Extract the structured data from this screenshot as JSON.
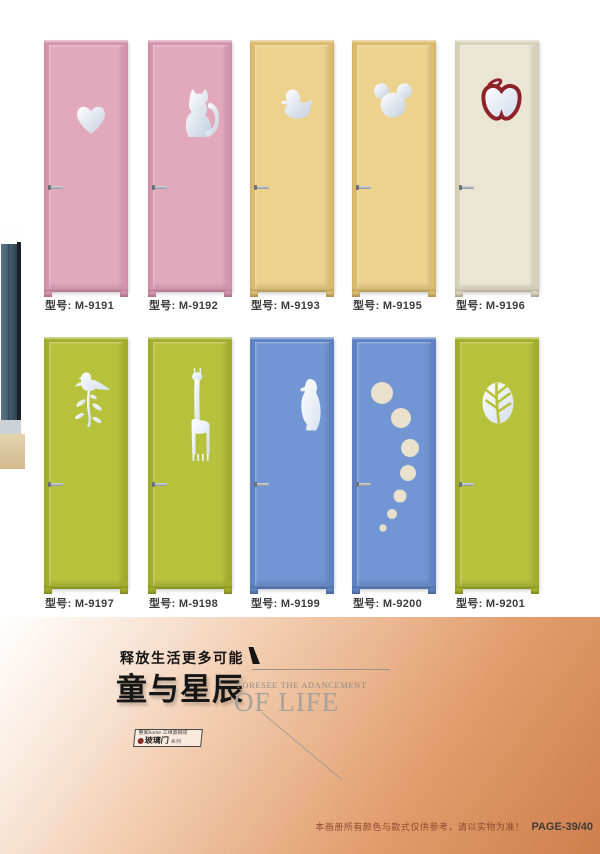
{
  "catalog": {
    "label_field_name": "型号",
    "doors": [
      {
        "model_label": "型号: M-9191",
        "shape": "heart",
        "slab_color": "#e2a9bd"
      },
      {
        "model_label": "型号: M-9192",
        "shape": "cat",
        "slab_color": "#e2a9bd"
      },
      {
        "model_label": "型号: M-9193",
        "shape": "duck",
        "slab_color": "#ecd28c"
      },
      {
        "model_label": "型号: M-9195",
        "shape": "mickey",
        "slab_color": "#ecd28c"
      },
      {
        "model_label": "型号: M-9196",
        "shape": "apple",
        "slab_color": "#ebe5d4"
      },
      {
        "model_label": "型号: M-9197",
        "shape": "bird-flower",
        "slab_color": "#b6c23c"
      },
      {
        "model_label": "型号: M-9198",
        "shape": "giraffe",
        "slab_color": "#b6c23c"
      },
      {
        "model_label": "型号: M-9199",
        "shape": "penguin",
        "slab_color": "#7295d3"
      },
      {
        "model_label": "型号: M-9200",
        "shape": "bubbles",
        "slab_color": "#7295d3"
      },
      {
        "model_label": "型号: M-9201",
        "shape": "leaf",
        "slab_color": "#b6c23c"
      }
    ]
  },
  "footer": {
    "slogan": "释放生活更多可能",
    "title_cn": "童与星辰",
    "subtitle_en_line1": "FORESEE THE ADANCEMENT",
    "subtitle_en_line2": "OF LIFE",
    "series_box_line1": "整家home 三维直销店",
    "series_box_main": "玻璃门",
    "series_box_sub": "系列",
    "disclaimer": "本画册所有颜色与款式仅供参考，请以实物为准！",
    "page_number": "PAGE-39/40"
  },
  "colors": {
    "glass_light": "#ffffff",
    "glass_dark": "#c3cfdf",
    "apple_outline": "#8e2228",
    "bubble_fill": "#e9e1cc",
    "footer_gradient_end": "#cf7f4c"
  }
}
